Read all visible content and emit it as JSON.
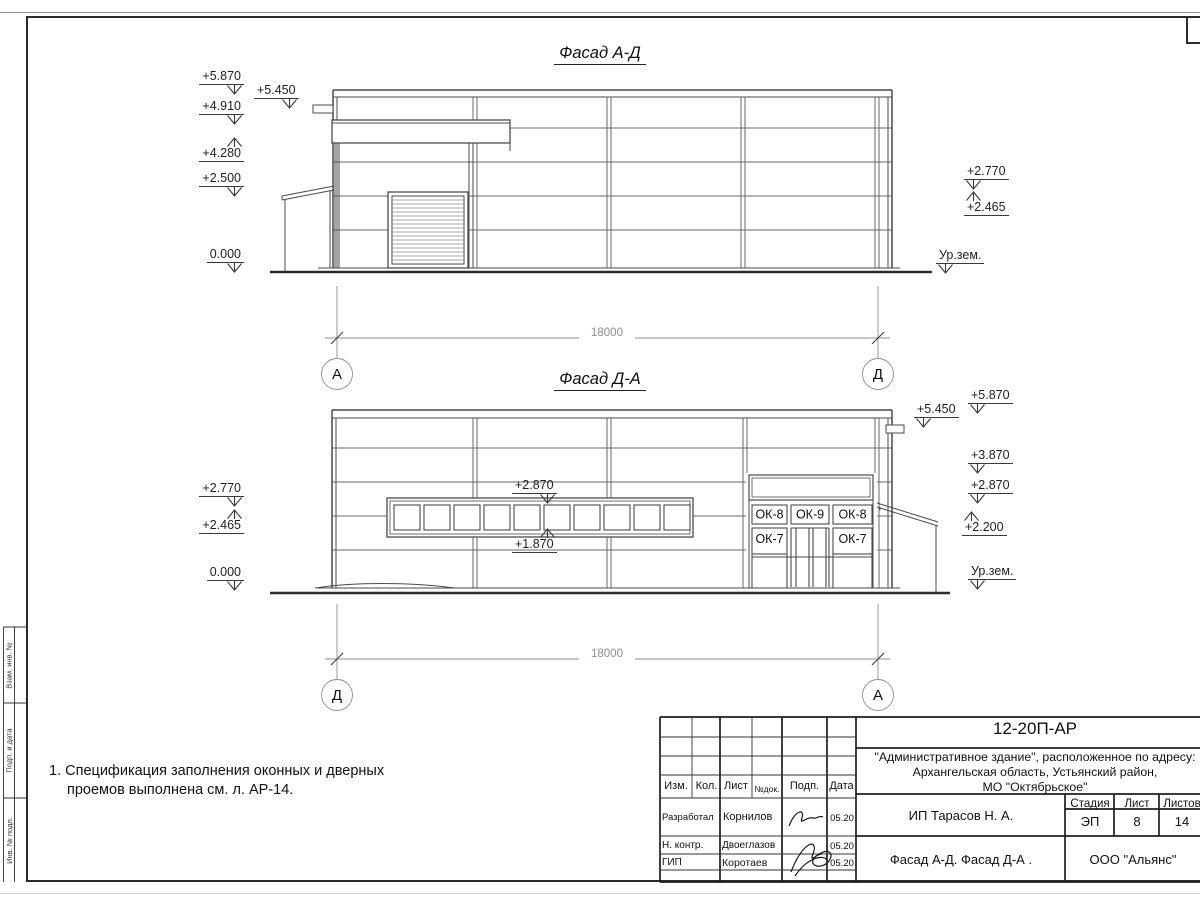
{
  "drawing": {
    "facade_ad": {
      "title": "Фасад А-Д",
      "marks": {
        "m5870": "+5.870",
        "m5450": "+5.450",
        "m4910": "+4.910",
        "m4280": "+4.280",
        "m2500": "+2.500",
        "m0000": "0.000",
        "m2770": "+2.770",
        "m2465": "+2.465",
        "ground": "Ур.зем."
      },
      "dim": "18000",
      "axis_left": "А",
      "axis_right": "Д"
    },
    "facade_da": {
      "title": "Фасад Д-А",
      "marks": {
        "m2770": "+2.770",
        "m2465": "+2.465",
        "m0000": "0.000",
        "m2870": "+2.870",
        "m1870": "+1.870",
        "r5870": "+5.870",
        "r5450": "+5.450",
        "r3870": "+3.870",
        "r2870": "+2.870",
        "r2200": "+2.200",
        "ground": "Ур.зем."
      },
      "windows": {
        "w1": "ОК-8",
        "w2": "ОК-9",
        "w3": "ОК-8",
        "w4": "ОК-7",
        "w5": "ОК-7"
      },
      "dim": "18000",
      "axis_left": "Д",
      "axis_right": "А"
    },
    "note": {
      "line1": "1. Спецификация заполнения оконных и дверных",
      "line2": "проемов выполнена см. л. АР-14."
    }
  },
  "frame": {
    "stamp_side": {
      "label1": "Взам. инв. №",
      "label2": "Подп. и дата",
      "label3": "Инв. № подл."
    }
  },
  "titleblock": {
    "doc_number": "12-20П-АР",
    "project_line1": "\"Административное здание\", расположенное по адресу:",
    "project_line2": "Архангельская область, Устьянский район,",
    "project_line3": "МО \"Октябрьское\"",
    "header_cols": [
      "Изм.",
      "Кол.",
      "Лист",
      "№док.",
      "Подп.",
      "Дата"
    ],
    "row_developed_label": "Разработал",
    "row_developed_name": "Корнилов",
    "row_developed_date": "05.20",
    "row_ncontrol_label": "Н. контр.",
    "row_ncontrol_name": "Двоеглазов",
    "row_ncontrol_date": "05.20",
    "row_gip_label": "ГИП",
    "row_gip_name": "Коротаев",
    "row_gip_date": "05.20",
    "client": "ИП Тарасов Н. А.",
    "stage_label": "Стадия",
    "sheet_label": "Лист",
    "sheets_label": "Листов",
    "stage_value": "ЭП",
    "sheet_value": "8",
    "sheets_value": "14",
    "sheet_title": "Фасад А-Д. Фасад Д-А .",
    "company": "ООО \"Альянс\""
  }
}
